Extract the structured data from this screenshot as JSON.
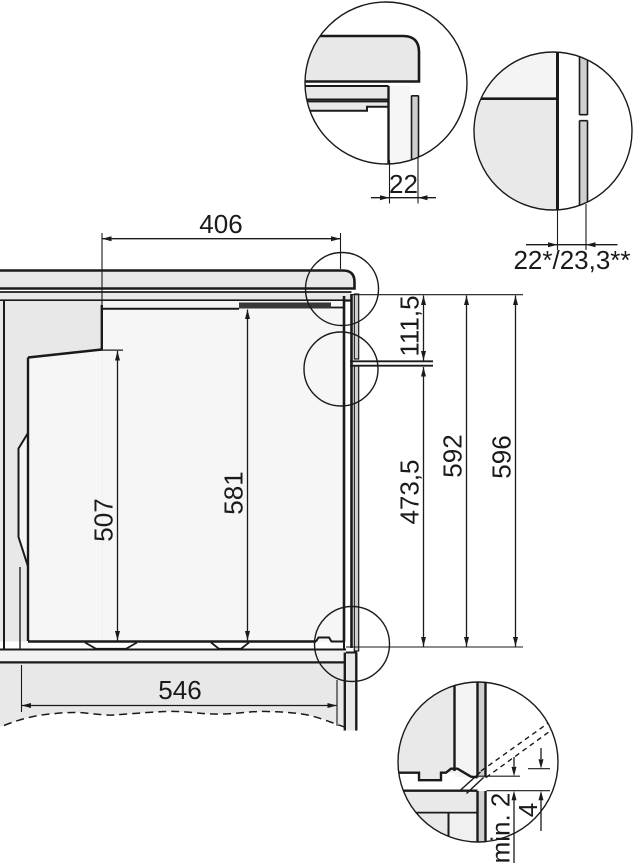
{
  "drawing": {
    "title": "built-in-oven-installation-side-view",
    "units": "mm",
    "colors": {
      "line": "#1a1a1a",
      "panel_light": "#e8e8e8",
      "panel_lighter": "#f4f4f4",
      "interior_white": "#f6f6f6",
      "strip_mid": "#cfcfcf",
      "bar_dark": "#383838",
      "shelf_fill": "#f2f2f2",
      "detail_left_fill": "#e9e9e9"
    },
    "dims": {
      "top_depth": "406",
      "upper_gap": "22",
      "rear_gap": "22*/23,3**",
      "socket_from_top": "111,5",
      "door_height": "507",
      "front_height": "581",
      "socket_from_bottom": "473,5",
      "niche_height": "592",
      "overall_height": "596",
      "base_depth": "546",
      "bottom_clearance": "min. 2",
      "bottom_offset": "4"
    }
  }
}
